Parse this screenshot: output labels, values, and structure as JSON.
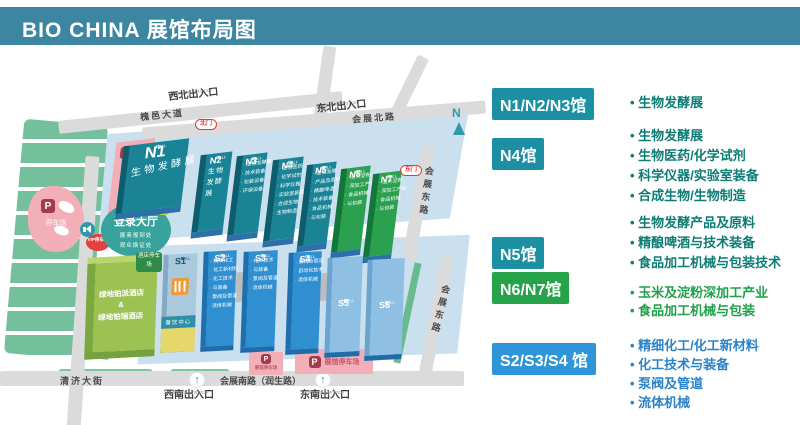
{
  "title": "BIO CHINA 展馆布局图",
  "compass": "N",
  "roads": {
    "huaiyi": "槐邑大道",
    "north": "会展北路",
    "east1": "会展东路",
    "east2": "会展东路",
    "yellow_river": "黄河大道",
    "qingji": "清济大街",
    "south": "会展南路（润生路）"
  },
  "entrances": {
    "nw_cn": "西北出入口",
    "nw_en": "Northwest Entrance",
    "ne_cn": "东北出入口",
    "ne_en": "Northeast Entrance",
    "sw_cn": "西南出入口",
    "sw_en": "Southwest Entrance",
    "se_cn": "东南出入口",
    "se_en": "Southeast Entrance",
    "arrow": "↑"
  },
  "gates": {
    "north": "北门",
    "east": "东门"
  },
  "login_hall": {
    "title": "登录大厅",
    "line1": "展商报到处",
    "line2": "观众换证处"
  },
  "parking": {
    "p": "P",
    "west_label": "停车场",
    "vip_label": "VIP停车场",
    "truck_label": "货车停车场",
    "hotel_label": "酒店停车场",
    "south_small": "展馆停车场",
    "south_large": "展馆停车场"
  },
  "hotel": {
    "line1": "绿地铂派酒店",
    "line2": "&",
    "line3": "绿地铂瑞酒店"
  },
  "dining_center": "餐饮中心",
  "halls": {
    "n1": {
      "num": "N1",
      "suffix": "馆",
      "sub": "HALL",
      "body": "生物发酵展"
    },
    "n2": {
      "num": "N2",
      "suffix": "馆",
      "sub": "HALL",
      "body": "生物发酵展"
    },
    "n3": {
      "num": "N3",
      "suffix": "馆",
      "sub": "HALL",
      "lines": [
        "生物发酵展",
        "技术装备",
        "包装设备",
        "环保设备"
      ]
    },
    "n4": {
      "num": "N4",
      "suffix": "馆",
      "sub": "HALL",
      "lines": [
        "生物医药",
        "化学试剂",
        "科学仪器",
        "实验室装备",
        "合成生物",
        "生物制造"
      ]
    },
    "n5": {
      "num": "N5",
      "suffix": "馆",
      "sub": "HALL",
      "lines": [
        "生物发酵",
        "产品及原料",
        "精酿啤酒",
        "技术装备",
        "食品机械",
        "与包装"
      ]
    },
    "n6": {
      "num": "N6",
      "suffix": "馆",
      "sub": "HALL",
      "lines": [
        "玉米淀粉",
        "深加工产业",
        "食品机械",
        "与包装"
      ]
    },
    "n7": {
      "num": "N7",
      "suffix": "馆",
      "sub": "HALL",
      "lines": [
        "玉米淀粉",
        "深加工产业",
        "食品机械",
        "与包装"
      ]
    },
    "s1": {
      "num": "S1",
      "suffix": "馆",
      "sub": "HALL"
    },
    "s2": {
      "num": "S2",
      "suffix": "馆",
      "sub": "HALL",
      "lines": [
        "精细化工",
        "化工新材料",
        "化工技术",
        "与装备",
        "泵阀及管道",
        "流体机械"
      ]
    },
    "s3": {
      "num": "S3",
      "suffix": "馆",
      "sub": "HALL",
      "lines": [
        "化工技术",
        "与装备",
        "泵阀及管道",
        "流体机械"
      ]
    },
    "s4": {
      "num": "S4",
      "suffix": "馆",
      "sub": "HALL",
      "lines": [
        "泵阀及管道",
        "自动化技术",
        "流体机械"
      ]
    },
    "s5": {
      "num": "S5",
      "suffix": "馆",
      "sub": "HALL"
    },
    "s6": {
      "num": "S6",
      "suffix": "馆",
      "sub": "HALL"
    }
  },
  "legend": {
    "rows": [
      {
        "badge": "N1/N2/N3馆",
        "color": "#1C8FA2",
        "text_color": "#0E7C74",
        "items": [
          "生物发酵展"
        ]
      },
      {
        "badge": "N4馆",
        "color": "#1C8FA2",
        "text_color": "#0E7C74",
        "items": [
          "生物发酵展",
          "生物医药/化学试剂",
          "科学仪器/实验室装备",
          "合成生物/生物制造"
        ]
      },
      {
        "badge": "N5馆",
        "color": "#1C8FA2",
        "text_color": "#0E7C74",
        "items": [
          "生物发酵产品及原料",
          "精酿啤酒与技术装备",
          "食品加工机械与包装技术"
        ]
      },
      {
        "badge": "N6/N7馆",
        "color": "#26A249",
        "text_color": "#1FA14B",
        "items": [
          "玉米及淀粉深加工产业",
          "食品加工机械与包装"
        ]
      },
      {
        "badge": "S2/S3/S4 馆",
        "color": "#2E96D8",
        "text_color": "#2C82C9",
        "items": [
          "精细化工/化工新材料",
          "化工技术与装备",
          "泵阀及管道",
          "流体机械"
        ]
      }
    ]
  }
}
